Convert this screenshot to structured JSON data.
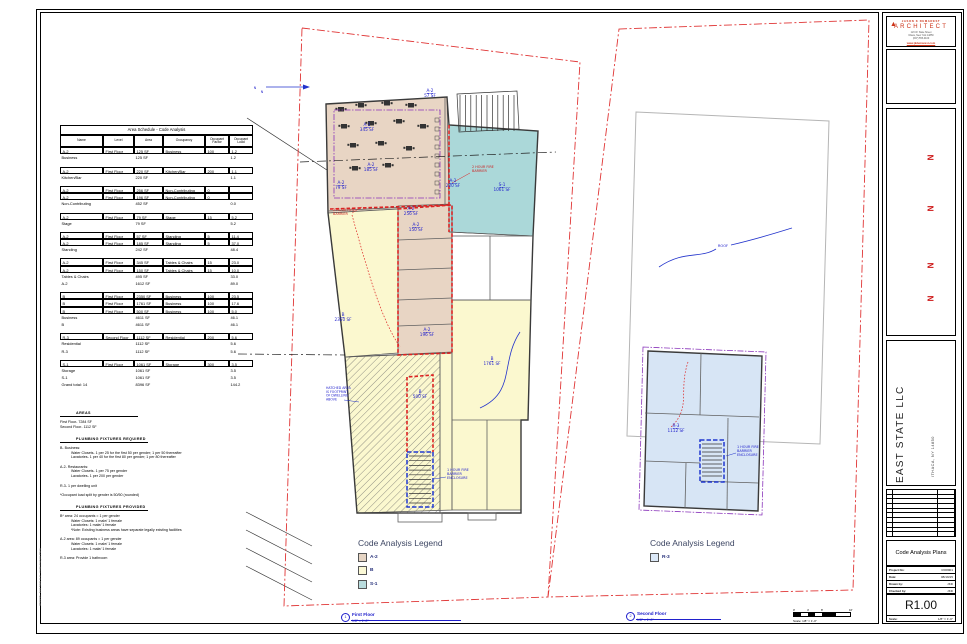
{
  "colors": {
    "a2": "#e8d5c4",
    "b": "#fbf8cf",
    "s1": "#abd8d9",
    "r3": "#d7e5f5"
  },
  "line_colors": {
    "fire_barrier": "#dd2222",
    "enclosure": "#2038d0",
    "property": "#e03535",
    "egress": "#8a35bb",
    "exit_path": "#dd2222"
  },
  "schedule": {
    "title": "Area Schedule - Code Analysis",
    "columns": [
      "Name",
      "Level",
      "Area",
      "Occupancy",
      "Occupant Factor",
      "Occupant Load"
    ],
    "col_widths": [
      43,
      31,
      29,
      42,
      24,
      24
    ],
    "rows": [
      {
        "t": "data",
        "c": [
          "A-2",
          "First Floor",
          "125 SF",
          "Business",
          "100",
          "1.2"
        ]
      },
      {
        "t": "sub",
        "c": [
          "Business",
          "",
          "125 SF",
          "",
          "",
          "1.2"
        ]
      },
      {
        "t": "gap"
      },
      {
        "t": "data",
        "c": [
          "A-2",
          "First Floor",
          "220 SF",
          "Kitchen/Bar",
          "200",
          "1.1"
        ]
      },
      {
        "t": "sub",
        "c": [
          "Kitchen/Bar",
          "",
          "220 SF",
          "",
          "",
          "1.1"
        ]
      },
      {
        "t": "gap"
      },
      {
        "t": "data",
        "c": [
          "A-2",
          "First Floor",
          "256 SF",
          "Non-Contributing",
          "0",
          ""
        ]
      },
      {
        "t": "data",
        "c": [
          "A-2",
          "First Floor",
          "196 SF",
          "Non-Contributing",
          "0",
          ""
        ]
      },
      {
        "t": "sub",
        "c": [
          "Non-Contributing",
          "",
          "452 SF",
          "",
          "",
          "0.0"
        ]
      },
      {
        "t": "gap"
      },
      {
        "t": "data",
        "c": [
          "A-2",
          "First Floor",
          "79 SF",
          "Stage",
          "15",
          "5.2"
        ]
      },
      {
        "t": "sub",
        "c": [
          "Stage",
          "",
          "79 SF",
          "",
          "",
          "5.2"
        ]
      },
      {
        "t": "gap"
      },
      {
        "t": "data",
        "c": [
          "A-2",
          "First Floor",
          "57 SF",
          "Standing",
          "5",
          "11.4"
        ]
      },
      {
        "t": "data",
        "c": [
          "A-2",
          "First Floor",
          "185 SF",
          "Standing",
          "5",
          "37.0"
        ]
      },
      {
        "t": "sub",
        "c": [
          "Standing",
          "",
          "242 SF",
          "",
          "",
          "48.4"
        ]
      },
      {
        "t": "gap"
      },
      {
        "t": "data",
        "c": [
          "A-2",
          "First Floor",
          "345 SF",
          "Tables & Chairs",
          "15",
          "23.0"
        ]
      },
      {
        "t": "data",
        "c": [
          "A-2",
          "First Floor",
          "150 SF",
          "Tables & Chairs",
          "15",
          "10.0"
        ]
      },
      {
        "t": "sub",
        "c": [
          "Tables & Chairs",
          "",
          "495 SF",
          "",
          "",
          "33.0"
        ]
      },
      {
        "t": "sub",
        "c": [
          "A-2",
          "",
          "1612 SF",
          "",
          "",
          "89.0"
        ]
      },
      {
        "t": "gap"
      },
      {
        "t": "data",
        "c": [
          "B",
          "First Floor",
          "2350 SF",
          "Business",
          "100",
          "23.5"
        ]
      },
      {
        "t": "data",
        "c": [
          "B",
          "First Floor",
          "1761 SF",
          "Business",
          "100",
          "17.6"
        ]
      },
      {
        "t": "data",
        "c": [
          "B",
          "First Floor",
          "500 SF",
          "Business",
          "100",
          "5.0"
        ]
      },
      {
        "t": "sub",
        "c": [
          "Business",
          "",
          "4611 SF",
          "",
          "",
          "46.1"
        ]
      },
      {
        "t": "sub",
        "c": [
          "B",
          "",
          "4611 SF",
          "",
          "",
          "46.1"
        ]
      },
      {
        "t": "gap"
      },
      {
        "t": "data",
        "c": [
          "R-3",
          "Second Floor",
          "1112 SF",
          "Residential",
          "200",
          "5.6"
        ]
      },
      {
        "t": "sub",
        "c": [
          "Residential",
          "",
          "1112 SF",
          "",
          "",
          "5.6"
        ]
      },
      {
        "t": "sub",
        "c": [
          "R-3",
          "",
          "1112 SF",
          "",
          "",
          "5.6"
        ]
      },
      {
        "t": "gap"
      },
      {
        "t": "data",
        "c": [
          "S-1",
          "First Floor",
          "1061 SF",
          "Storage",
          "300",
          "3.5"
        ]
      },
      {
        "t": "sub",
        "c": [
          "Storage",
          "",
          "1061 SF",
          "",
          "",
          "3.5"
        ]
      },
      {
        "t": "sub",
        "c": [
          "S-1",
          "",
          "1061 SF",
          "",
          "",
          "3.5"
        ]
      },
      {
        "t": "sub",
        "c": [
          "Grand total: 14",
          "",
          "8396 SF",
          "",
          "",
          "144.2"
        ]
      }
    ]
  },
  "notes": {
    "sections": [
      {
        "heading": "AREAS",
        "w": 62,
        "lines": [
          {
            "t": "First Floor- 7284 SF",
            "i": 0
          },
          {
            "t": "Second Floor- 1112 SF",
            "i": 0
          }
        ]
      },
      {
        "heading": "PLUMBING FIXTURES REQUIRED",
        "w": 72,
        "lines": [
          {
            "t": "B- Business:",
            "i": 0
          },
          {
            "t": "Water Closets- 1 per 25 for the first 50 per gender; 1 per 50 thereafter",
            "i": 1
          },
          {
            "t": "Lavatories- 1 per 40 for the first 80 per gender; 1 per 80 thereafter",
            "i": 1
          },
          {
            "t": "",
            "i": 0
          },
          {
            "t": "A-2- Restaurants:",
            "i": 0
          },
          {
            "t": "Water Closets- 1 per 75 per gender",
            "i": 1
          },
          {
            "t": "Lavatories- 1 per 200 per gender",
            "i": 1
          },
          {
            "t": "",
            "i": 0
          },
          {
            "t": "R-3- 1 per dwelling unit",
            "i": 0
          },
          {
            "t": "",
            "i": 0
          },
          {
            "t": "*Occupant load split by gender is 50/50 (rounded)",
            "i": 0
          }
        ]
      },
      {
        "heading": "PLUMBING FIXTURES PROVIDED",
        "w": 72,
        "lines": [
          {
            "t": "B* area: 24 occupants = 1 per gender",
            "i": 0
          },
          {
            "t": "Water Closets: 1 male/ 1 female",
            "i": 1
          },
          {
            "t": "Lavatories: 1 male/ 1 female",
            "i": 1
          },
          {
            "t": "*Note: Existing business areas have separate legally existing facilities",
            "i": 1
          },
          {
            "t": "",
            "i": 0
          },
          {
            "t": "A-2 area: 89 occupants = 1 per gender",
            "i": 0
          },
          {
            "t": "Water Closets: 1 male/ 1 female",
            "i": 1
          },
          {
            "t": "Lavatories: 1 male/ 1 female",
            "i": 1
          },
          {
            "t": "",
            "i": 0
          },
          {
            "t": "R-3 area: Provide 1 bathroom",
            "i": 0
          }
        ]
      }
    ]
  },
  "legends": [
    {
      "title": "Code Analysis Legend",
      "items": [
        {
          "label": "A-2",
          "color": "#e6d5c4"
        },
        {
          "label": "B",
          "color": "#fbf9d6"
        },
        {
          "label": "S-1",
          "color": "#b9dcdd"
        }
      ]
    },
    {
      "title": "Code Analysis Legend",
      "items": [
        {
          "label": "R-3",
          "color": "#dbe8f7"
        }
      ]
    }
  ],
  "callouts": [
    {
      "num": "1",
      "label": "First Floor",
      "scale": "1/8\" = 1'-0\""
    },
    {
      "num": "2",
      "label": "Second Floor",
      "scale": "1/8\" = 1'-0\""
    }
  ],
  "scalebar": {
    "labels": [
      "0'",
      "4'",
      "8'",
      "16'"
    ],
    "caption": "Scale: 1/8\" = 1'-0\""
  },
  "plan": {
    "labels": [
      {
        "x": 430,
        "y": 92,
        "lines": [
          "A-2",
          "57 SF"
        ],
        "tag": true
      },
      {
        "x": 367,
        "y": 126,
        "lines": [
          "A-2",
          "345 SF"
        ],
        "tag": true
      },
      {
        "x": 371,
        "y": 166,
        "lines": [
          "A-2",
          "185 SF"
        ],
        "tag": true
      },
      {
        "x": 341,
        "y": 184,
        "lines": [
          "A-2",
          "79 SF"
        ],
        "tag": true
      },
      {
        "x": 453,
        "y": 182,
        "lines": [
          "A-2",
          "220 SF"
        ],
        "tag": true
      },
      {
        "x": 502,
        "y": 186,
        "lines": [
          "S-1",
          "1061 SF"
        ],
        "tag": true
      },
      {
        "x": 472,
        "y": 168,
        "anchor": "start",
        "color": "red",
        "size": 3.4,
        "lines": [
          "2 HOUR FIRE",
          "BARRIER"
        ]
      },
      {
        "x": 333,
        "y": 211,
        "anchor": "start",
        "color": "red",
        "size": 3.4,
        "lines": [
          "2 HOUR FIRE",
          "BARRIER"
        ]
      },
      {
        "x": 411,
        "y": 210,
        "lines": [
          "A-2",
          "256 SF"
        ],
        "tag": true
      },
      {
        "x": 416,
        "y": 226,
        "lines": [
          "A-2",
          "150 SF"
        ],
        "tag": true
      },
      {
        "x": 343,
        "y": 316,
        "lines": [
          "B",
          "2350 SF"
        ],
        "tag": true
      },
      {
        "x": 427,
        "y": 331,
        "lines": [
          "A-2",
          "196 SF"
        ],
        "tag": true
      },
      {
        "x": 492,
        "y": 360,
        "lines": [
          "B",
          "1761 SF"
        ],
        "tag": true
      },
      {
        "x": 420,
        "y": 393,
        "lines": [
          "B",
          "500 SF"
        ],
        "tag": true
      },
      {
        "x": 326,
        "y": 389,
        "anchor": "start",
        "size": 3.2,
        "lines": [
          "HATCHED AREA",
          "IS FOOTPRINT",
          "OF DWELLING",
          "ABOVE"
        ]
      },
      {
        "x": 447,
        "y": 471,
        "anchor": "start",
        "size": 3.4,
        "lines": [
          "1 HOUR FIRE",
          "BARRIER",
          "ENCLOSURE"
        ]
      },
      {
        "x": 723,
        "y": 247,
        "size": 3.6,
        "lines": [
          "ROOF"
        ]
      },
      {
        "x": 676,
        "y": 427,
        "lines": [
          "R-3",
          "1112 SF"
        ],
        "tag": true
      },
      {
        "x": 737,
        "y": 448,
        "anchor": "start",
        "size": 3.4,
        "lines": [
          "1 HOUR FIRE",
          "BARRIER",
          "ENCLOSURE"
        ]
      },
      {
        "x": 255,
        "y": 89,
        "size": 3.4,
        "lines": [
          "N"
        ]
      },
      {
        "x": 262,
        "y": 93,
        "size": 3.4,
        "lines": [
          "N"
        ]
      }
    ]
  },
  "titleblock": {
    "firm_line1": "JASON K DEMAREST",
    "firm_line2": "ARCHITECT",
    "address": [
      "123 W. State Street",
      "Ithaca, New York 14850",
      "(607) 555-0100"
    ],
    "website": "www.jkdemarest.com",
    "north_marker": "N",
    "north_marker_count": 4,
    "client": "EAST STATE LLC",
    "location": "ITHACA, NY 14850",
    "sheet_title": "Code Analysis Plans",
    "fields": [
      {
        "label": "Project No:",
        "value": "RO8901"
      },
      {
        "label": "Date:",
        "value": "08/19/15"
      },
      {
        "label": "Drawn by:",
        "value": "JKD"
      },
      {
        "label": "Checked by:",
        "value": "JKD"
      }
    ],
    "sheet_number": "R1.00",
    "scale_label": "Scale:",
    "scale_value": "1/8\" = 1'-0\"",
    "plot_stamp": "08/19/15 - East State LLC - Code Analysis Plans"
  }
}
